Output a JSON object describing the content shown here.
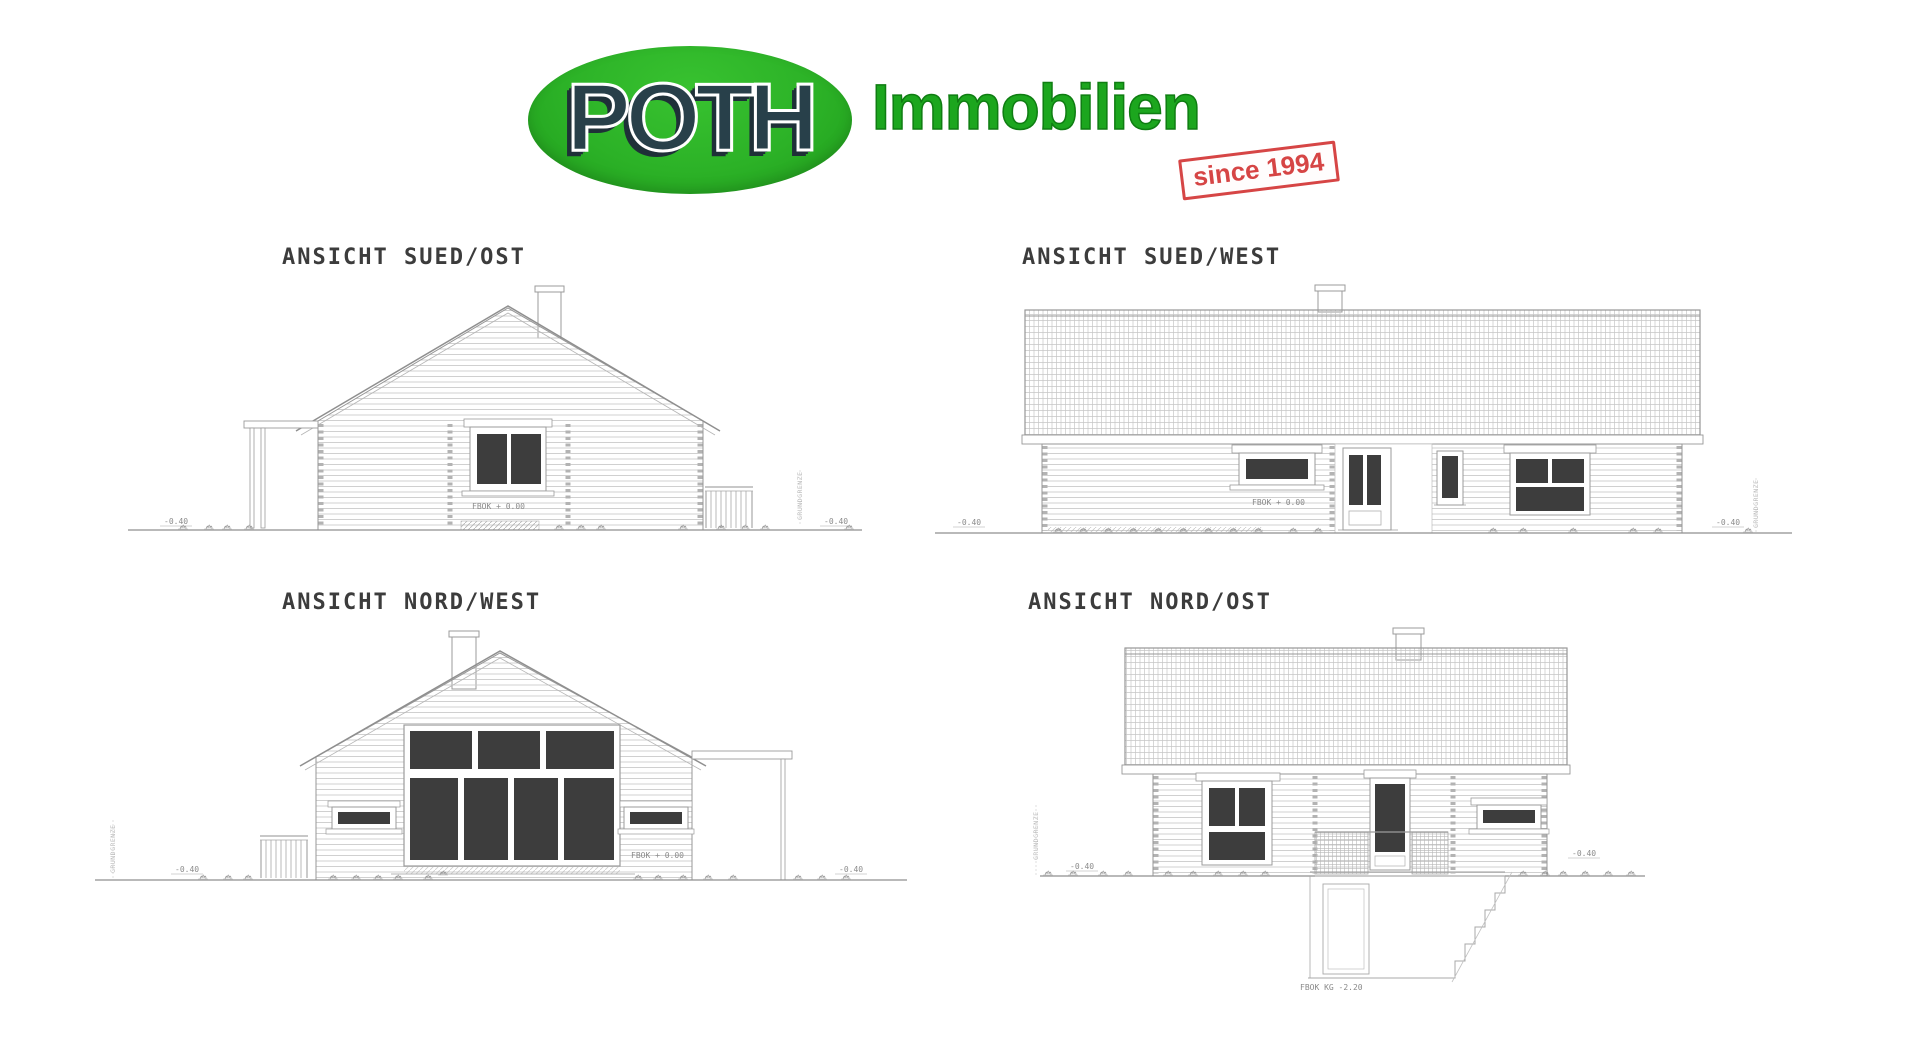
{
  "logo": {
    "brand": "POTH",
    "suffix": "Immobilien",
    "stamp": "since 1994",
    "colors": {
      "ellipse_green": "#2cb227",
      "brand_navy": "#28404a",
      "suffix_green": "#1ca61e",
      "stamp_red": "#d64545"
    }
  },
  "views": [
    {
      "id": "sued-ost",
      "title": "ANSICHT SUED/OST",
      "floor_label": "FBOK + 0.00",
      "level_left": "-0.40",
      "level_right": "-0.40",
      "boundary_label": "GRUNDGRENZE"
    },
    {
      "id": "sued-west",
      "title": "ANSICHT SUED/WEST",
      "floor_label": "FBOK + 0.00",
      "level_left": "-0.40",
      "level_right": "-0.40",
      "boundary_label": "GRUNDGRENZE"
    },
    {
      "id": "nord-west",
      "title": "ANSICHT NORD/WEST",
      "floor_label": "FBOK + 0.00",
      "level_left": "-0.40",
      "level_right": "-0.40",
      "boundary_label": "GRUNDGRENZE"
    },
    {
      "id": "nord-ost",
      "title": "ANSICHT NORD/OST",
      "basement_label": "FBOK KG -2.20",
      "level_left": "-0.40",
      "level_right": "-0.40",
      "boundary_label": "GRUNDGRENZE"
    }
  ]
}
